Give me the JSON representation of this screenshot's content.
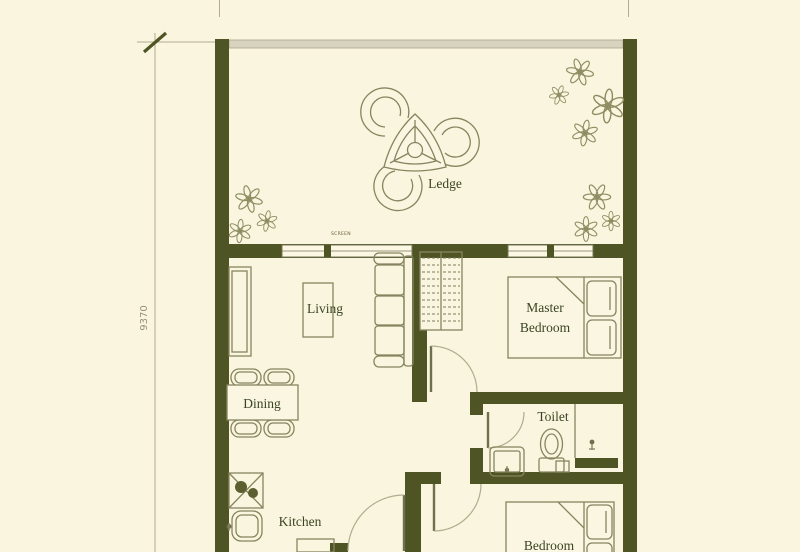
{
  "plan": {
    "rooms": {
      "ledge": "Ledge",
      "living": "Living",
      "master_line1": "Master",
      "master_line2": "Bedroom",
      "dining": "Dining",
      "toilet": "Toilet",
      "kitchen": "Kitchen",
      "bedroom": "Bedroom"
    },
    "dimension_left": "9370",
    "window_tag": "SCREEN",
    "colors": {
      "background": "#FAF5DE",
      "wall": "#4E5423",
      "furniture_line": "#85855F",
      "label_text": "#3B4422",
      "dimension_line": "#B2AB93",
      "parapet": "#D8D3BF"
    }
  }
}
